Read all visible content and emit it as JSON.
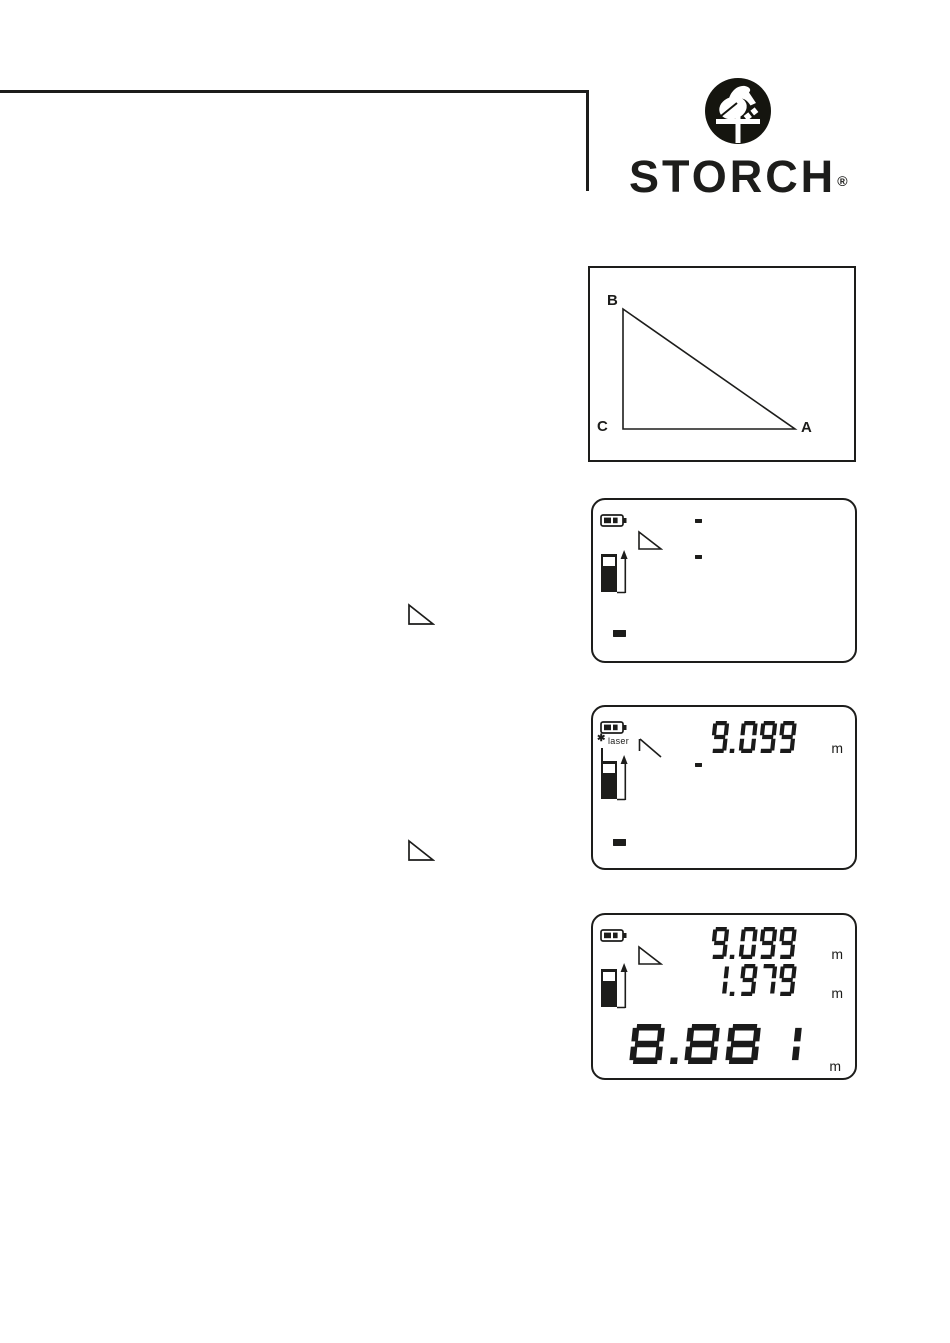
{
  "brand": {
    "name": "STORCH",
    "registered": "®"
  },
  "colors": {
    "ink": "#1d1d1b",
    "paper": "#ffffff"
  },
  "icons": {
    "logo": "stork-icon",
    "battery": "battery-icon",
    "device": "laser-device-icon",
    "arrow": "measure-direction-arrow-icon",
    "triangle": "indirect-measure-triangle-icon",
    "laser_symbol": "✱"
  },
  "diagram": {
    "label_b": "B",
    "label_c": "C",
    "label_a": "A"
  },
  "displays": [
    {
      "state": "ready",
      "line1_dashes": 6,
      "line2_dashes": 6,
      "main_dashes": 6
    },
    {
      "state": "first-measurement",
      "laser_symbol": "✱",
      "laser_label": "laser",
      "line1_value": "9.099",
      "line1_unit": "m",
      "line2_dashes": 6,
      "main_dashes": 6
    },
    {
      "state": "result",
      "line1_value": "9.099",
      "line1_unit": "m",
      "line2_value": "1.979",
      "line2_unit": "m",
      "main_value": "8.881",
      "main_unit": "m"
    }
  ]
}
